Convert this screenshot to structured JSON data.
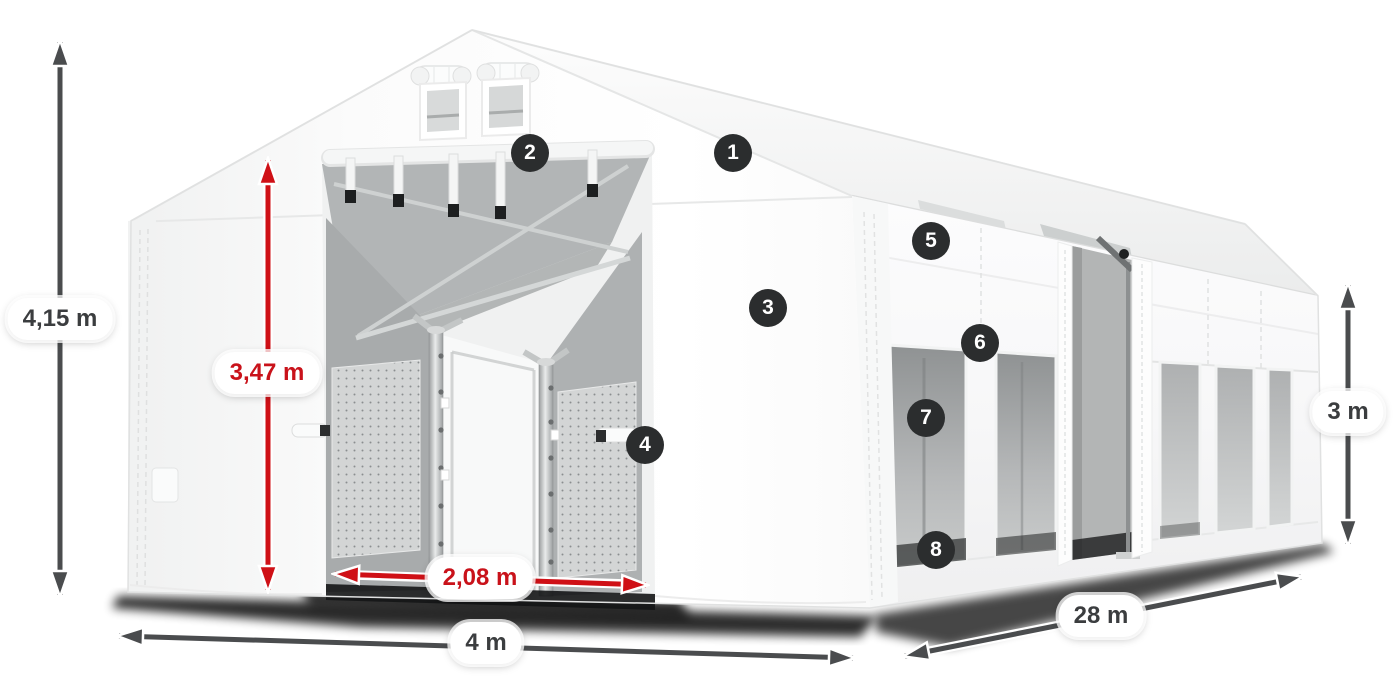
{
  "dimensions": {
    "total_height": "4,15 m",
    "inner_height": "3,47 m",
    "entrance_width": "2,08 m",
    "width": "4 m",
    "length": "28 m",
    "side_height": "3 m"
  },
  "callouts": {
    "labels": [
      "1",
      "2",
      "3",
      "4",
      "5",
      "6",
      "7",
      "8"
    ]
  },
  "colors": {
    "accent_red": "#cf1016",
    "red_label_text": "#c9121a",
    "arrow_dark": "#4a4c4e",
    "dark_label_text": "#3b3d3f",
    "badge_background": "#2b2d2e",
    "tent_white": "#ffffff",
    "interior_gray": "#b3b6b7",
    "window_gray": "#9a9d9e"
  }
}
